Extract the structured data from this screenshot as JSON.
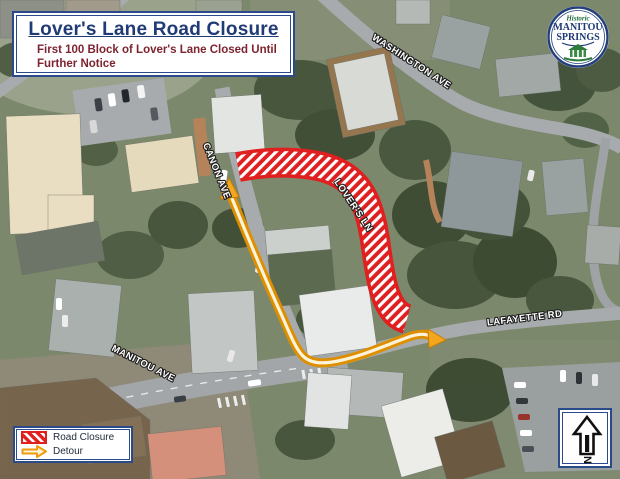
{
  "header": {
    "title": "Lover's Lane Road Closure",
    "subtitle_line1": "First 100 Block of Lover's Lane Closed Until",
    "subtitle_line2": "Further Notice"
  },
  "logo": {
    "historic": "Historic",
    "manitou": "MANITOU",
    "springs": "SPRINGS"
  },
  "streets": {
    "washington": "WASHINGTON AVE",
    "canon": "CANON AVE",
    "lovers": "LOVER'S LN",
    "lafayette": "LAFAYETTE RD",
    "manitou": "MANITOU AVE"
  },
  "legend": {
    "road_closure": "Road Closure",
    "detour": "Detour"
  },
  "north_label": "N",
  "colors": {
    "closure_red": "#e02020",
    "detour_orange": "#ef9b0c",
    "frame_navy": "#1c3d7a",
    "title_navy": "#203b75",
    "subtitle_maroon": "#7d2430"
  }
}
